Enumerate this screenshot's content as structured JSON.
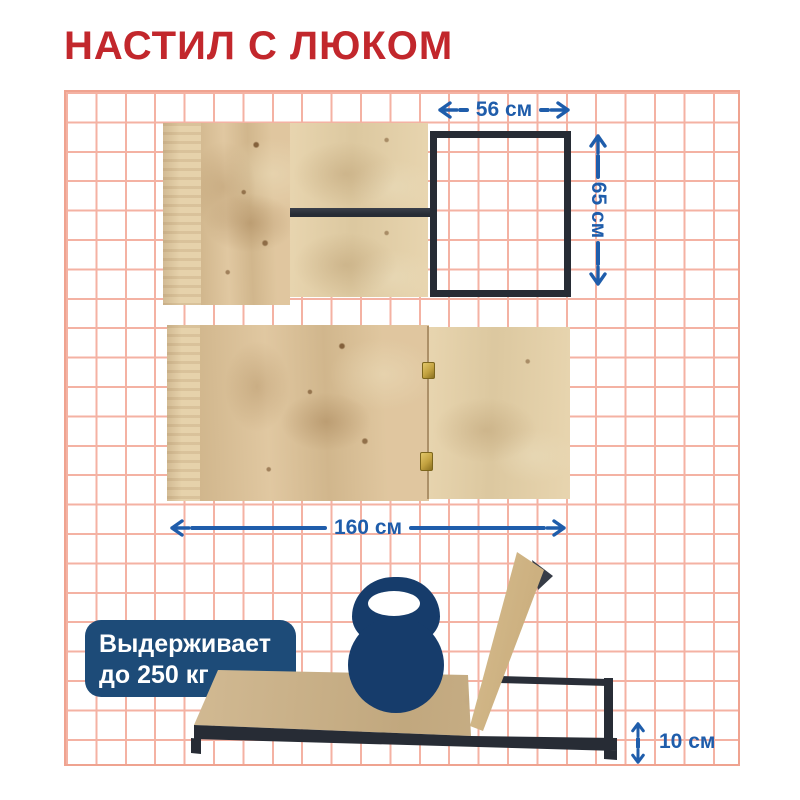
{
  "title": {
    "text": "НАСТИЛ С ЛЮКОМ"
  },
  "dimensions": {
    "hatch_width": "56 см",
    "hatch_height": "65 см",
    "deck_length": "160 см",
    "frame_height": "10 см"
  },
  "badge": {
    "line1": "Выдерживает",
    "line2": "до 250 кг"
  },
  "icons": {
    "kettlebell": "kettlebell-icon"
  },
  "colors": {
    "title_red": "#c2272c",
    "dim_blue": "#1f5dab",
    "badge_navy": "#1d4b78",
    "kettlebell_navy": "#163c6b",
    "grid_pink": "#f4b2a3",
    "grid_border": "#efa390",
    "metal_dark": "#272c35",
    "plywood_tan": "#dcc094",
    "hinge_gold": "#c2a13f"
  }
}
